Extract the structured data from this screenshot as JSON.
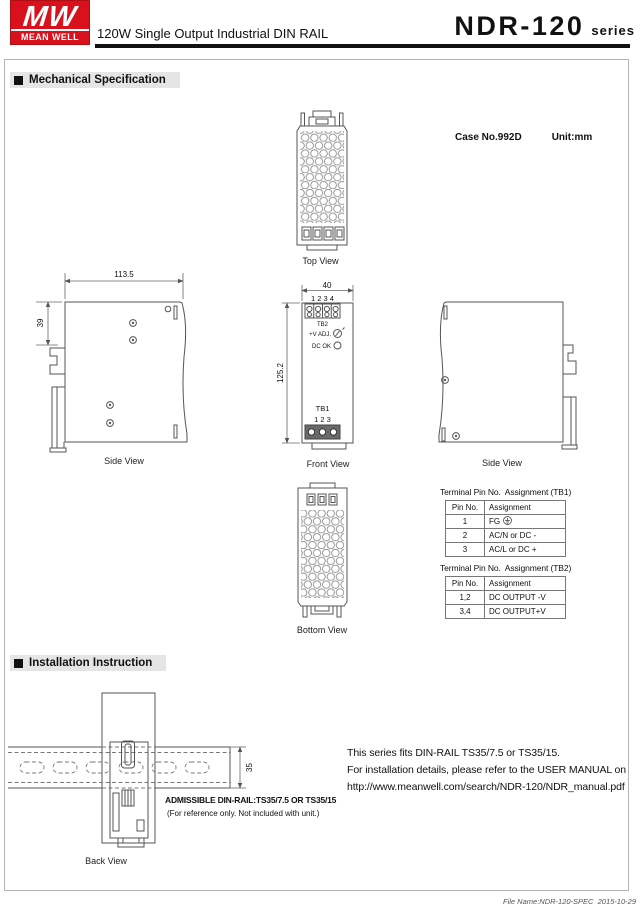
{
  "header": {
    "logo": {
      "mw": "MW",
      "name": "MEAN WELL"
    },
    "product_line": "120W Single Output Industrial DIN RAIL",
    "model": "NDR-120",
    "series_suffix": "series",
    "brand_red": "#d8111c"
  },
  "sections": {
    "mechanical": "Mechanical Specification",
    "installation": "Installation Instruction"
  },
  "case_info": {
    "case_no": "Case No.992D",
    "unit": "Unit:mm"
  },
  "view_labels": {
    "top": "Top View",
    "side_left": "Side View",
    "front": "Front View",
    "side_right": "Side View",
    "bottom": "Bottom View",
    "back": "Back View"
  },
  "dimensions": {
    "side_width": "113.5",
    "side_depth": "39",
    "front_width": "40",
    "front_height": "125.2",
    "rail_height": "35"
  },
  "front_view": {
    "tb2_pins": "1 2 3 4",
    "tb2_label": "TB2",
    "vadj_label": "+V ADJ.",
    "dcok_label": "DC OK",
    "tb1_label": "TB1",
    "tb1_pins": "1 2 3"
  },
  "tables": {
    "tb1": {
      "title": "Terminal Pin No.  Assignment (TB1)",
      "headers": [
        "Pin No.",
        "Assignment"
      ],
      "rows": [
        [
          "1",
          "FG"
        ],
        [
          "2",
          "AC/N or DC -"
        ],
        [
          "3",
          "AC/L or DC +"
        ]
      ]
    },
    "tb2": {
      "title": "Terminal Pin No.  Assignment (TB2)",
      "headers": [
        "Pin No.",
        "Assignment"
      ],
      "rows": [
        [
          "1,2",
          "DC OUTPUT -V"
        ],
        [
          "3,4",
          "DC OUTPUT+V"
        ]
      ]
    }
  },
  "installation": {
    "admissible": "ADMISSIBLE DIN-RAIL:TS35/7.5 OR TS35/15",
    "reference_note": "(For reference only. Not included with unit.)",
    "note_lines": [
      "This series fits DIN-RAIL TS35/7.5 or TS35/15.",
      "For installation details, please refer to the USER MANUAL on",
      "http://www.meanwell.com/search/NDR-120/NDR_manual.pdf"
    ]
  },
  "footer": {
    "file_info": "File Name:NDR-120-SPEC  2015-10-29"
  }
}
